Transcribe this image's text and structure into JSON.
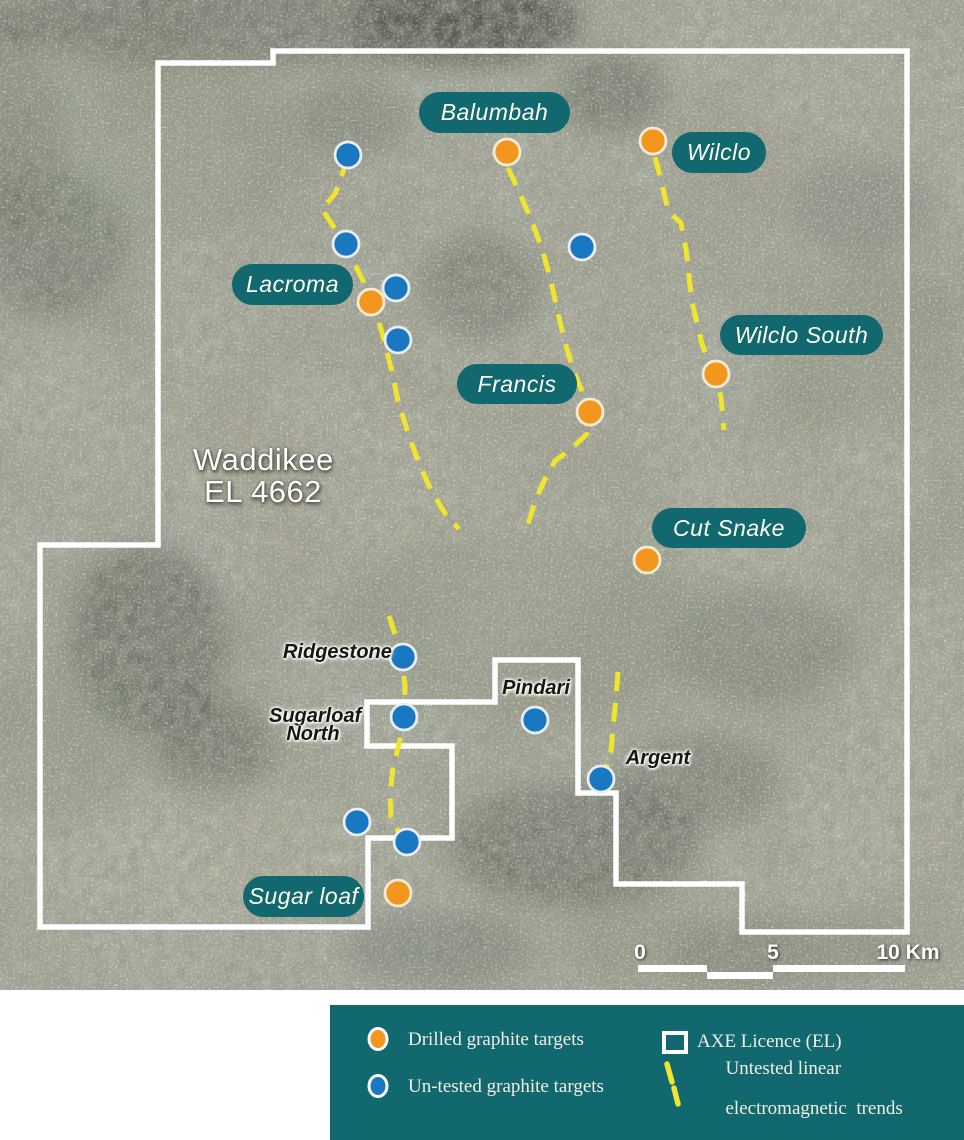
{
  "colors": {
    "teal": "#11686e",
    "orange": "#f2961d",
    "orange_ring": "#f3ecd4",
    "blue": "#1a78c0",
    "blue_ring": "#e8eef3",
    "yellow": "#efe42e",
    "white": "#ffffff"
  },
  "map": {
    "title_line1": "Waddikee",
    "title_line2": "EL 4662",
    "boundary_path": "M158,63 L158,545 L40,545 L40,927 L368,927 L368,838 L452,838 L452,746 L367,746 L367,702 L495,702 L495,660 L578,660 L578,793 L616,793 L616,884 L742,884 L742,932 L907,932 L907,51 L273,51 L273,63 Z",
    "trend_paths": [
      "M348,158 L335,194 L322,209 L337,232 L352,258 L366,287 L377,315 L385,344 L392,372 L398,401 L409,436 L420,466 L432,492 L446,515 L459,529",
      "M508,168 L521,196 L533,224 L543,252 L551,281 L557,309 L564,339 L573,369 L584,396 L591,413 L587,434 L572,448 L555,461 L544,481 L535,502 L528,524",
      "M655,157 L662,184 L668,211 L681,223 L686,249 L689,276 L692,302 L697,323 L702,344 L708,361 L716,375 L721,398 L724,430",
      "M389,616 L396,637 L402,658 L405,687 L404,716 L399,744 L393,769 L390,794 L391,817 L399,833 L406,843",
      "M618,672 L616,699 L613,727 L611,751 L606,769 L601,779"
    ],
    "targets": {
      "drilled": [
        [
          507,
          152
        ],
        [
          653,
          141
        ],
        [
          371,
          302
        ],
        [
          716,
          374
        ],
        [
          590,
          412
        ],
        [
          647,
          560
        ],
        [
          398,
          893
        ]
      ],
      "untested": [
        [
          348,
          155
        ],
        [
          346,
          244
        ],
        [
          396,
          288
        ],
        [
          398,
          340
        ],
        [
          582,
          247
        ],
        [
          403,
          657
        ],
        [
          404,
          717
        ],
        [
          535,
          720
        ],
        [
          601,
          779
        ],
        [
          357,
          822
        ],
        [
          407,
          842
        ]
      ]
    },
    "pill_labels": [
      {
        "text": "Balumbah",
        "x": 419,
        "y": 92,
        "w": 151,
        "h": 41
      },
      {
        "text": "Wilclo",
        "x": 672,
        "y": 132,
        "w": 94,
        "h": 41
      },
      {
        "text": "Lacroma",
        "x": 232,
        "y": 264,
        "w": 121,
        "h": 41
      },
      {
        "text": "Wilclo South",
        "x": 720,
        "y": 315,
        "w": 163,
        "h": 40
      },
      {
        "text": "Francis",
        "x": 457,
        "y": 364,
        "w": 120,
        "h": 40
      },
      {
        "text": "Cut Snake",
        "x": 652,
        "y": 508,
        "w": 154,
        "h": 40
      },
      {
        "text": "Sugar loaf",
        "x": 243,
        "y": 876,
        "w": 121,
        "h": 41
      }
    ],
    "text_labels": [
      {
        "lines": [
          "Ridgestone"
        ],
        "x": 283,
        "y": 643,
        "w": 96
      },
      {
        "lines": [
          "Pindari"
        ],
        "x": 500,
        "y": 679,
        "w": 72
      },
      {
        "lines": [
          "Argent"
        ],
        "x": 623,
        "y": 749,
        "w": 70
      },
      {
        "lines": [
          "Sugarloaf",
          "North"
        ],
        "x": 269,
        "y": 707,
        "w": 88
      }
    ],
    "scale_bar": {
      "labels": [
        {
          "text": "0",
          "x": 640,
          "y": 941
        },
        {
          "text": "5",
          "x": 773,
          "y": 941
        },
        {
          "text": "10 Km",
          "x": 908,
          "y": 941
        }
      ],
      "segments": [
        {
          "x": 638,
          "y": 965,
          "w": 69,
          "h": 7
        },
        {
          "x": 707,
          "y": 972,
          "w": 66,
          "h": 7
        },
        {
          "x": 773,
          "y": 965,
          "w": 132,
          "h": 7
        }
      ]
    }
  },
  "legend": {
    "drilled_label": "Drilled graphite targets",
    "untested_label": "Un-tested graphite targets",
    "licence_label": "AXE Licence (EL)",
    "trend_label_line1": "Untested linear",
    "trend_label_line2": "electromagnetic  trends"
  }
}
